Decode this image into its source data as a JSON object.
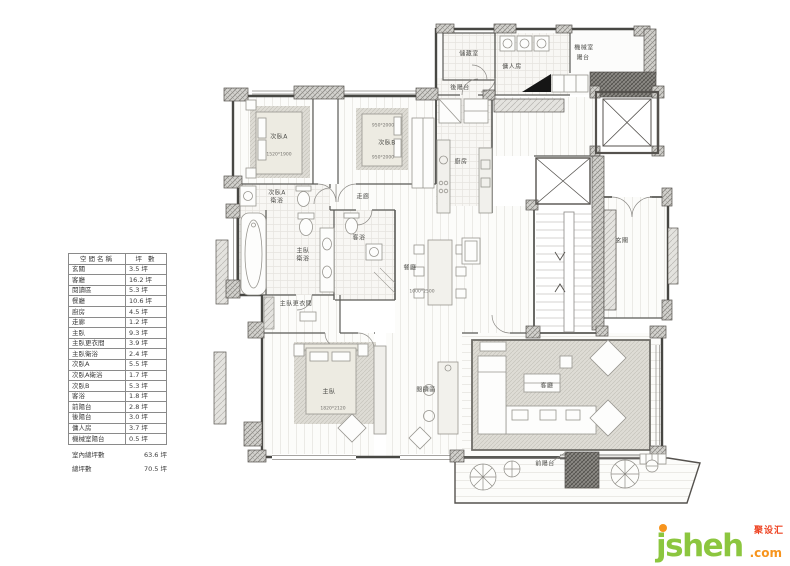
{
  "table": {
    "header": {
      "name": "空間名稱",
      "unit": "坪  數"
    },
    "rows": [
      {
        "name": "玄關",
        "value": "3.5 坪"
      },
      {
        "name": "客廳",
        "value": "16.2 坪"
      },
      {
        "name": "閱讀區",
        "value": "5.3 坪"
      },
      {
        "name": "餐廳",
        "value": "10.6 坪"
      },
      {
        "name": "廚房",
        "value": "4.5 坪"
      },
      {
        "name": "走廊",
        "value": "1.2 坪"
      },
      {
        "name": "主臥",
        "value": "9.3 坪"
      },
      {
        "name": "主臥更衣間",
        "value": "3.9 坪"
      },
      {
        "name": "主臥衛浴",
        "value": "2.4 坪"
      },
      {
        "name": "次臥A",
        "value": "5.5 坪"
      },
      {
        "name": "次臥A衛浴",
        "value": "1.7 坪"
      },
      {
        "name": "次臥B",
        "value": "5.3 坪"
      },
      {
        "name": "客浴",
        "value": "1.8 坪"
      },
      {
        "name": "前陽台",
        "value": "2.8 坪"
      },
      {
        "name": "後陽台",
        "value": "3.0 坪"
      },
      {
        "name": "傭人房",
        "value": "3.7 坪"
      },
      {
        "name": "機械室陽台",
        "value": "0.5 坪"
      }
    ],
    "summary": [
      {
        "label": "室內總坪數",
        "value": "63.6 坪"
      },
      {
        "label": "總坪數",
        "value": "70.5 坪"
      }
    ]
  },
  "plan": {
    "labels": {
      "storage": "儲藏室",
      "back_balcony": "後陽台",
      "maid_room": "傭人房",
      "machine_room_line1": "機械室",
      "machine_room_line2": "陽台",
      "bedroom_a": "次臥A",
      "bedroom_a_dim": "1520*1900",
      "bedroom_b": "次臥B",
      "bedroom_b_dim_top": "950*2000",
      "bedroom_b_dim_bottom": "950*2000",
      "kitchen": "廚房",
      "corridor": "走廊",
      "bedroom_a_bath_line1": "次臥A",
      "bedroom_a_bath_line2": "衛浴",
      "master_bath_line1": "主臥",
      "master_bath_line2": "衛浴",
      "guest_bath": "客浴",
      "dining": "餐廳",
      "dining_dim": "1000*2500",
      "foyer": "玄關",
      "master_closet": "主臥更衣間",
      "master": "主臥",
      "master_dim": "1820*2120",
      "reading": "閱讀區",
      "living": "客廳",
      "front_balcony": "前陽台"
    }
  },
  "logo": {
    "brand": "jsheh",
    "tld": ".com",
    "cn": "聚设汇",
    "colors": {
      "green": "#8cc63f",
      "orange": "#f7941d",
      "red": "#ee4423"
    }
  }
}
